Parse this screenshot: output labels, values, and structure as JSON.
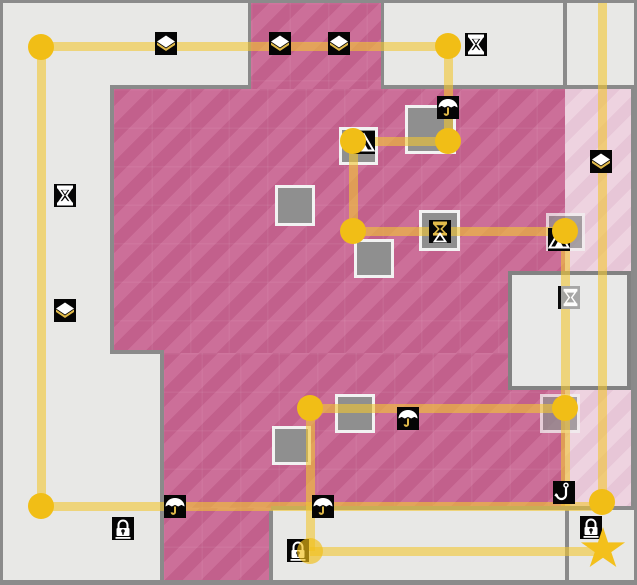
{
  "map": {
    "width": 637,
    "height": 585,
    "palette": {
      "background": "#e8e8e6",
      "border": "#8b8b8b",
      "pink_dark_a": "#c2608c",
      "pink_dark_b": "#cc6f99",
      "pink_light_a": "#e7c6d7",
      "pink_light_b": "#eed3e0",
      "wall": "#8a8a8a",
      "box_fill": "#8f8f8f",
      "box_border": "#f2f2f2",
      "room_fill": "#e9e9e8",
      "room_border": "#828282",
      "path": "rgba(242,198,50,0.6)",
      "node": "#f1be16",
      "star": "#f3c01c",
      "icon_bg": "#050505",
      "icon_glyph": "#ffffff",
      "icon_gold": "#e2bb4a"
    },
    "regions": [
      {
        "kind": "pink-dark",
        "x": 248,
        "y": 0,
        "w": 130,
        "h": 86
      },
      {
        "kind": "pink-dark",
        "x": 110,
        "y": 86,
        "w": 452,
        "h": 264
      },
      {
        "kind": "pink-dark",
        "x": 160,
        "y": 350,
        "w": 402,
        "h": 155
      },
      {
        "kind": "pink-dark",
        "x": 160,
        "y": 505,
        "w": 108,
        "h": 77
      },
      {
        "kind": "pink-light",
        "x": 562,
        "y": 86,
        "w": 68,
        "h": 417
      }
    ],
    "walls": [
      {
        "x": 107,
        "y": 82,
        "w": 141,
        "h": 4
      },
      {
        "x": 378,
        "y": 82,
        "w": 254,
        "h": 4
      },
      {
        "x": 107,
        "y": 82,
        "w": 4,
        "h": 269
      },
      {
        "x": 107,
        "y": 347,
        "w": 54,
        "h": 4
      },
      {
        "x": 157,
        "y": 347,
        "w": 4,
        "h": 235
      },
      {
        "x": 245,
        "y": 0,
        "w": 3,
        "h": 82
      },
      {
        "x": 378,
        "y": 0,
        "w": 3,
        "h": 82
      },
      {
        "x": 560,
        "y": 0,
        "w": 4,
        "h": 86
      },
      {
        "x": 628,
        "y": 86,
        "w": 3,
        "h": 417
      },
      {
        "x": 268,
        "y": 503,
        "w": 364,
        "h": 4
      },
      {
        "x": 266,
        "y": 507,
        "w": 4,
        "h": 75
      },
      {
        "x": 562,
        "y": 507,
        "w": 4,
        "h": 75
      }
    ],
    "inner_room": {
      "x": 505,
      "y": 268,
      "w": 123,
      "h": 119
    },
    "gray_boxes": [
      {
        "x": 272,
        "y": 182,
        "w": 40,
        "h": 41
      },
      {
        "x": 351,
        "y": 236,
        "w": 40,
        "h": 39
      },
      {
        "x": 402,
        "y": 102,
        "w": 51,
        "h": 49
      },
      {
        "x": 336,
        "y": 124,
        "w": 39,
        "h": 38
      },
      {
        "x": 416,
        "y": 207,
        "w": 41,
        "h": 41
      },
      {
        "x": 543,
        "y": 210,
        "w": 39,
        "h": 38,
        "faded": true
      },
      {
        "x": 332,
        "y": 391,
        "w": 40,
        "h": 39
      },
      {
        "x": 269,
        "y": 423,
        "w": 39,
        "h": 39
      },
      {
        "x": 537,
        "y": 391,
        "w": 40,
        "h": 39,
        "faded": true
      }
    ],
    "path_segments": [
      {
        "x1": 38,
        "y1": 43,
        "x2": 445,
        "y2": 43
      },
      {
        "x1": 38,
        "y1": 44,
        "x2": 38,
        "y2": 503
      },
      {
        "x1": 445,
        "y1": 43,
        "x2": 445,
        "y2": 138
      },
      {
        "x1": 350,
        "y1": 138,
        "x2": 445,
        "y2": 138
      },
      {
        "x1": 350,
        "y1": 138,
        "x2": 350,
        "y2": 228
      },
      {
        "x1": 350,
        "y1": 228,
        "x2": 562,
        "y2": 228
      },
      {
        "x1": 562,
        "y1": 228,
        "x2": 562,
        "y2": 503
      },
      {
        "x1": 307,
        "y1": 405,
        "x2": 562,
        "y2": 405
      },
      {
        "x1": 307,
        "y1": 405,
        "x2": 307,
        "y2": 548
      },
      {
        "x1": 38,
        "y1": 503,
        "x2": 599,
        "y2": 503
      },
      {
        "x1": 599,
        "y1": 0,
        "x2": 599,
        "y2": 499
      },
      {
        "x1": 307,
        "y1": 548,
        "x2": 601,
        "y2": 548
      }
    ],
    "nodes": [
      {
        "x": 38,
        "y": 44
      },
      {
        "x": 445,
        "y": 43
      },
      {
        "x": 445,
        "y": 138
      },
      {
        "x": 350,
        "y": 138
      },
      {
        "x": 350,
        "y": 228
      },
      {
        "x": 562,
        "y": 228
      },
      {
        "x": 562,
        "y": 405
      },
      {
        "x": 307,
        "y": 405
      },
      {
        "x": 38,
        "y": 503
      },
      {
        "x": 599,
        "y": 499
      },
      {
        "x": 307,
        "y": 548,
        "faded": true
      }
    ],
    "icons": [
      {
        "type": "diamond",
        "x": 152,
        "y": 29
      },
      {
        "type": "diamond",
        "x": 266,
        "y": 29
      },
      {
        "type": "diamond",
        "x": 325,
        "y": 29
      },
      {
        "type": "hourglass",
        "x": 462,
        "y": 30
      },
      {
        "type": "hourglass",
        "x": 51,
        "y": 181
      },
      {
        "type": "diamond",
        "x": 51,
        "y": 296
      },
      {
        "type": "diamond",
        "x": 587,
        "y": 147
      },
      {
        "type": "umbrella",
        "x": 434,
        "y": 93
      },
      {
        "type": "tent",
        "x": 350,
        "y": 128
      },
      {
        "type": "hourglass-tent",
        "x": 426,
        "y": 217
      },
      {
        "type": "tent",
        "x": 545,
        "y": 225
      },
      {
        "type": "hourglass-gray",
        "x": 555,
        "y": 283
      },
      {
        "type": "umbrella",
        "x": 394,
        "y": 404
      },
      {
        "type": "umbrella",
        "x": 161,
        "y": 492
      },
      {
        "type": "umbrella",
        "x": 309,
        "y": 492
      },
      {
        "type": "hook",
        "x": 550,
        "y": 478
      },
      {
        "type": "lock",
        "x": 109,
        "y": 514
      },
      {
        "type": "lock",
        "x": 284,
        "y": 536
      },
      {
        "type": "lock",
        "x": 577,
        "y": 513
      }
    ],
    "goal_star": {
      "x": 600,
      "y": 546
    }
  }
}
